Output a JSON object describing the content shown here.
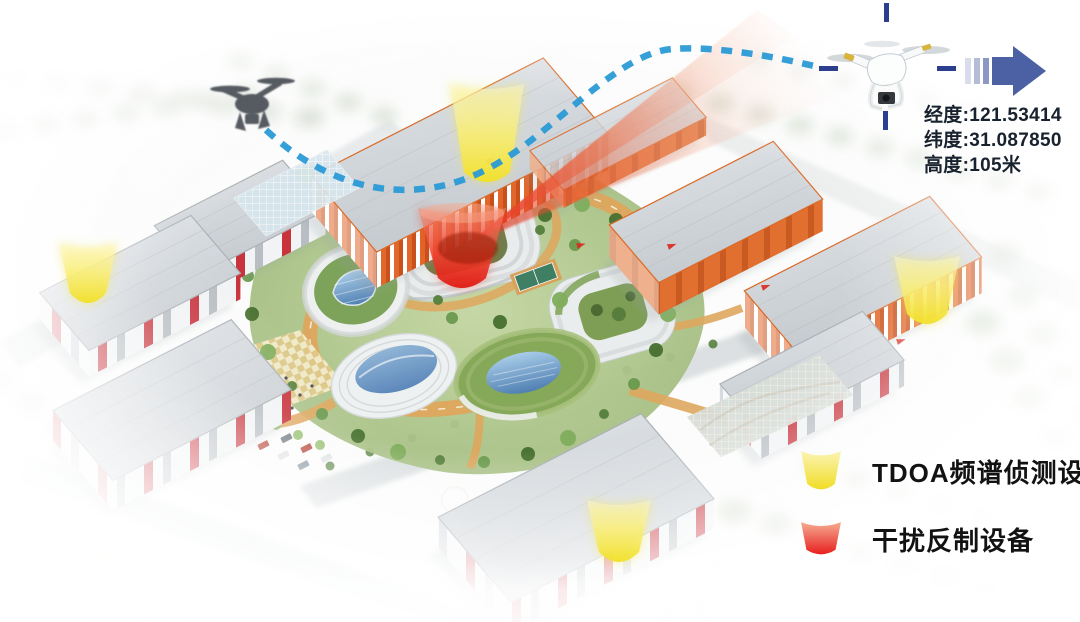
{
  "telemetry": {
    "lines": [
      "经度:121.53414",
      "纬度:31.087850",
      "高度:105米"
    ]
  },
  "legend": {
    "items": [
      {
        "id": "tdoa-sensor",
        "icon": "yellow-cone-icon",
        "label": "TDOA频谱侦测设备",
        "color_top": "#fbf4b4",
        "color_bottom": "#f0dd26"
      },
      {
        "id": "jammer",
        "icon": "red-cone-icon",
        "label": "干扰反制设备",
        "color_top": "#f5ac92",
        "color_bottom": "#e81f1f"
      }
    ]
  },
  "scene": {
    "tdoa_sensors": [
      {
        "x": 487,
        "top_y": 84,
        "top_w": 74,
        "bot_w": 46,
        "h": 100
      },
      {
        "x": 88,
        "top_y": 243,
        "top_w": 58,
        "bot_w": 36,
        "h": 62
      },
      {
        "x": 927,
        "top_y": 256,
        "top_w": 66,
        "bot_w": 40,
        "h": 70
      },
      {
        "x": 619,
        "top_y": 500,
        "top_w": 64,
        "bot_w": 40,
        "h": 64
      }
    ],
    "jammer_cone": {
      "x": 462,
      "top_y": 208,
      "top_w": 88,
      "bot_w": 48,
      "h": 82
    },
    "beam": {
      "apex": [
        468,
        244
      ],
      "top_left": [
        757,
        10
      ],
      "top_right": [
        866,
        84
      ]
    },
    "flight_path": "M266,130 C318,178 374,196 430,188 C494,179 538,134 584,97 C622,66 648,51 672,49 C712,46 768,55 814,66",
    "intruder_drone": {
      "x": 212,
      "y": 74
    },
    "target_drone": {
      "x": 828,
      "y": 32
    }
  },
  "colors": {
    "flight_path_blue": "#2a9ad6",
    "crosshair_navy": "#2b3f8e",
    "direction_arrow_blue": "#4c61a3",
    "jam_beam_red": "#e5301f",
    "tdoa_cone_yellow": "#f2e02a",
    "jammer_cone_red": "#e01a12",
    "telemetry_text": "#18222e",
    "legend_text": "#121212"
  }
}
